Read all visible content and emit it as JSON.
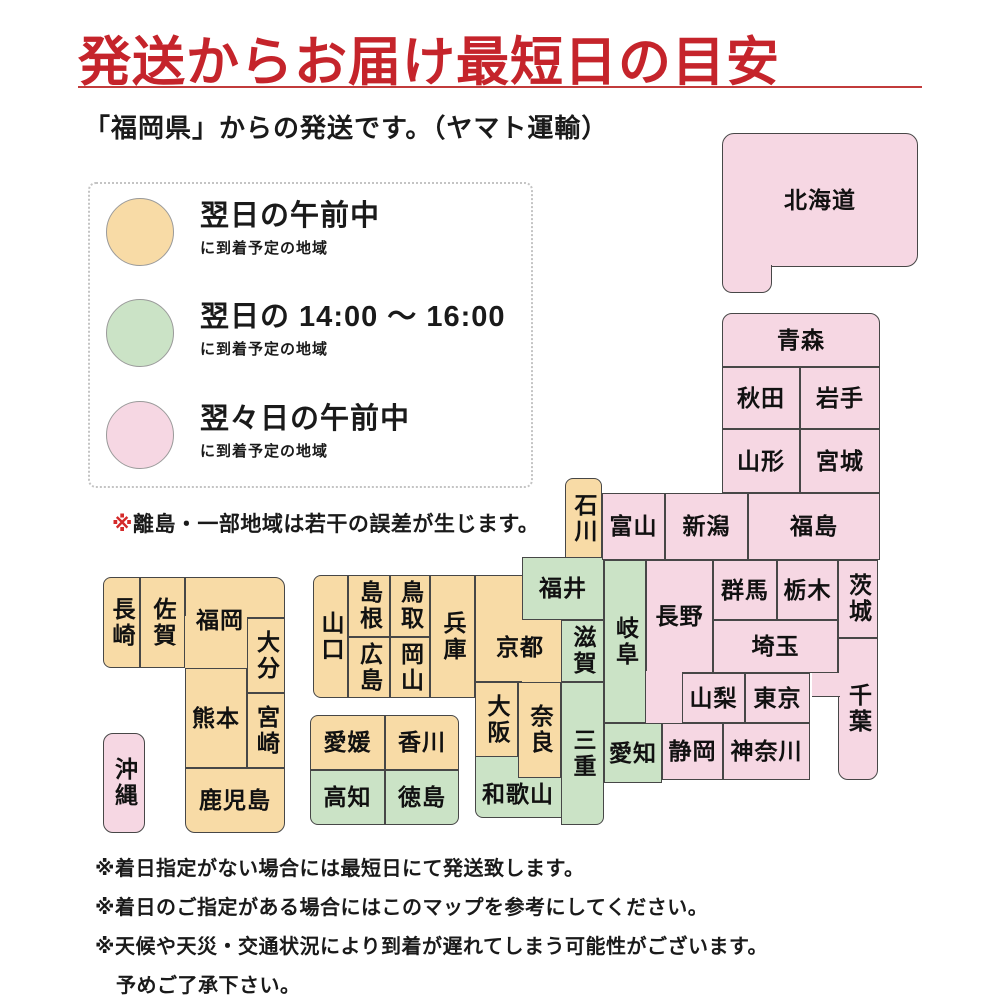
{
  "theme": {
    "title_red": "#c5242b",
    "rule_red": "#c23b3b",
    "note_red": "#d42a2a",
    "map_border": "#474747"
  },
  "header": {
    "title": "発送からお届け最短日の目安",
    "subtitle": "「福岡県」からの発送です。（ヤマト運輸）"
  },
  "legend": {
    "items": [
      {
        "key": "next_am",
        "title": "翌日の午前中",
        "sub": "に到着予定の地域"
      },
      {
        "key": "next_pm",
        "title": "翌日の 14:00 ～ 16:00",
        "sub": "に到着予定の地域"
      },
      {
        "key": "next2_am",
        "title": "翌々日の午前中",
        "sub": "に到着予定の地域"
      }
    ],
    "note_marker": "※",
    "note_text": "離島・一部地域は若干の誤差が生じます。"
  },
  "footnotes": [
    "※着日指定がない場合には最短日にて発送致します。",
    "※着日のご指定がある場合にはこのマップを参考にしてください。",
    "※天候や天災・交通状況により到着が遅れてしまう可能性がございます。",
    "予めご了承下さい。"
  ],
  "map": {
    "colors": {
      "next_am": "#F8DBA6",
      "next_pm": "#CBE3C6",
      "next2_am": "#F6D7E3"
    },
    "legend_meaning": {
      "next_am": "翌日の午前中に到着予定の地域",
      "next_pm": "翌日の14:00～16:00に到着予定の地域",
      "next2_am": "翌々日の午前中に到着予定の地域"
    },
    "prefectures": [
      {
        "id": "nagasaki",
        "label": "長崎",
        "color": "next_am",
        "vertical": true,
        "shapes": [
          {
            "x": 103,
            "y": 577,
            "w": 37,
            "h": 91,
            "r": "8 0 0 8"
          }
        ]
      },
      {
        "id": "saga",
        "label": "佐賀",
        "color": "next_am",
        "vertical": true,
        "shapes": [
          {
            "x": 140,
            "y": 577,
            "w": 45,
            "h": 91
          }
        ]
      },
      {
        "id": "fukuoka",
        "label": "福岡",
        "color": "next_am",
        "vertical": false,
        "shapes": [
          {
            "x": 185,
            "y": 577,
            "w": 100,
            "h": 41,
            "r": "0 10 0 0"
          },
          {
            "x": 185,
            "y": 616,
            "w": 62,
            "h": 52,
            "b": ""
          }
        ],
        "label_box": {
          "x": 185,
          "y": 590,
          "w": 70,
          "h": 60
        }
      },
      {
        "id": "oita",
        "label": "大分",
        "color": "next_am",
        "vertical": true,
        "shapes": [
          {
            "x": 247,
            "y": 618,
            "w": 38,
            "h": 75
          }
        ]
      },
      {
        "id": "kumamoto",
        "label": "熊本",
        "color": "next_am",
        "vertical": false,
        "shapes": [
          {
            "x": 185,
            "y": 668,
            "w": 62,
            "h": 100
          }
        ]
      },
      {
        "id": "miyazaki",
        "label": "宮崎",
        "color": "next_am",
        "vertical": true,
        "shapes": [
          {
            "x": 247,
            "y": 693,
            "w": 38,
            "h": 75
          }
        ]
      },
      {
        "id": "kagoshima",
        "label": "鹿児島",
        "color": "next_am",
        "vertical": false,
        "shapes": [
          {
            "x": 185,
            "y": 768,
            "w": 100,
            "h": 65,
            "r": "0 0 10 10"
          }
        ]
      },
      {
        "id": "yamaguchi",
        "label": "山口",
        "color": "next_am",
        "vertical": true,
        "shapes": [
          {
            "x": 313,
            "y": 575,
            "w": 35,
            "h": 123,
            "r": "8 0 0 8"
          }
        ]
      },
      {
        "id": "shimane",
        "label": "島根",
        "color": "next_am",
        "vertical": true,
        "shapes": [
          {
            "x": 348,
            "y": 575,
            "w": 42,
            "h": 62
          }
        ]
      },
      {
        "id": "tottori",
        "label": "鳥取",
        "color": "next_am",
        "vertical": true,
        "shapes": [
          {
            "x": 390,
            "y": 575,
            "w": 40,
            "h": 62
          }
        ]
      },
      {
        "id": "hiroshima",
        "label": "広島",
        "color": "next_am",
        "vertical": true,
        "shapes": [
          {
            "x": 348,
            "y": 637,
            "w": 42,
            "h": 61
          }
        ]
      },
      {
        "id": "okayama",
        "label": "岡山",
        "color": "next_am",
        "vertical": true,
        "shapes": [
          {
            "x": 390,
            "y": 637,
            "w": 40,
            "h": 61
          }
        ]
      },
      {
        "id": "hyogo",
        "label": "兵庫",
        "color": "next_am",
        "vertical": true,
        "shapes": [
          {
            "x": 430,
            "y": 575,
            "w": 45,
            "h": 123
          }
        ]
      },
      {
        "id": "kyoto",
        "label": "京都",
        "color": "next_am",
        "vertical": false,
        "shapes": [
          {
            "x": 475,
            "y": 575,
            "w": 47,
            "h": 107,
            "b": "ltb"
          },
          {
            "x": 522,
            "y": 620,
            "w": 39,
            "h": 62,
            "b": ""
          }
        ],
        "label_box": {
          "x": 480,
          "y": 625,
          "w": 80,
          "h": 45
        }
      },
      {
        "id": "osaka",
        "label": "大阪",
        "color": "next_am",
        "vertical": true,
        "shapes": [
          {
            "x": 475,
            "y": 682,
            "w": 43,
            "h": 75
          }
        ]
      },
      {
        "id": "nara",
        "label": "奈良",
        "color": "next_am",
        "vertical": true,
        "shapes": [
          {
            "x": 518,
            "y": 682,
            "w": 43,
            "h": 96
          }
        ]
      },
      {
        "id": "ehime",
        "label": "愛媛",
        "color": "next_am",
        "vertical": false,
        "shapes": [
          {
            "x": 310,
            "y": 715,
            "w": 75,
            "h": 55,
            "r": "8 0 0 0"
          }
        ]
      },
      {
        "id": "kagawa",
        "label": "香川",
        "color": "next_am",
        "vertical": false,
        "shapes": [
          {
            "x": 385,
            "y": 715,
            "w": 74,
            "h": 55,
            "r": "0 8 0 0"
          }
        ]
      },
      {
        "id": "ishikawa",
        "label": "石川",
        "color": "next_am",
        "vertical": true,
        "shapes": [
          {
            "x": 565,
            "y": 478,
            "w": 37,
            "h": 82,
            "r": "8 8 0 0"
          }
        ]
      },
      {
        "id": "kochi",
        "label": "高知",
        "color": "next_pm",
        "vertical": false,
        "shapes": [
          {
            "x": 310,
            "y": 770,
            "w": 75,
            "h": 55,
            "r": "0 0 0 8"
          }
        ]
      },
      {
        "id": "tokushima",
        "label": "徳島",
        "color": "next_pm",
        "vertical": false,
        "shapes": [
          {
            "x": 385,
            "y": 770,
            "w": 74,
            "h": 55,
            "r": "0 0 8 0"
          }
        ]
      },
      {
        "id": "wakayama",
        "label": "和歌山",
        "color": "next_pm",
        "vertical": false,
        "shapes": [
          {
            "x": 475,
            "y": 757,
            "w": 43,
            "h": 61,
            "b": "lb",
            "r": "0 0 0 8"
          },
          {
            "x": 518,
            "y": 778,
            "w": 43,
            "h": 40,
            "b": "b"
          }
        ],
        "label_box": {
          "x": 475,
          "y": 770,
          "w": 86,
          "h": 48
        }
      },
      {
        "id": "mie",
        "label": "三重",
        "color": "next_pm",
        "vertical": true,
        "shapes": [
          {
            "x": 561,
            "y": 682,
            "w": 43,
            "h": 143,
            "r": "0 0 8 0"
          }
        ]
      },
      {
        "id": "shiga",
        "label": "滋賀",
        "color": "next_pm",
        "vertical": true,
        "shapes": [
          {
            "x": 561,
            "y": 620,
            "w": 43,
            "h": 62
          }
        ]
      },
      {
        "id": "fukui",
        "label": "福井",
        "color": "next_pm",
        "vertical": false,
        "shapes": [
          {
            "x": 522,
            "y": 557,
            "w": 82,
            "h": 63
          }
        ]
      },
      {
        "id": "gifu",
        "label": "岐阜",
        "color": "next_pm",
        "vertical": true,
        "shapes": [
          {
            "x": 604,
            "y": 560,
            "w": 42,
            "h": 163
          }
        ]
      },
      {
        "id": "aichi",
        "label": "愛知",
        "color": "next_pm",
        "vertical": false,
        "shapes": [
          {
            "x": 604,
            "y": 723,
            "w": 58,
            "h": 60
          }
        ]
      },
      {
        "id": "okinawa",
        "label": "沖縄",
        "color": "next2_am",
        "vertical": true,
        "shapes": [
          {
            "x": 103,
            "y": 733,
            "w": 42,
            "h": 100,
            "r": "10 10 10 10"
          }
        ]
      },
      {
        "id": "toyama",
        "label": "富山",
        "color": "next2_am",
        "vertical": false,
        "shapes": [
          {
            "x": 602,
            "y": 493,
            "w": 63,
            "h": 67
          }
        ]
      },
      {
        "id": "niigata",
        "label": "新潟",
        "color": "next2_am",
        "vertical": false,
        "shapes": [
          {
            "x": 665,
            "y": 493,
            "w": 83,
            "h": 67
          }
        ]
      },
      {
        "id": "nagano",
        "label": "長野",
        "color": "next2_am",
        "vertical": false,
        "shapes": [
          {
            "x": 646,
            "y": 560,
            "w": 67,
            "h": 113
          },
          {
            "x": 646,
            "y": 671,
            "w": 36,
            "h": 52,
            "b": ""
          }
        ],
        "label_box": {
          "x": 646,
          "y": 560,
          "w": 67,
          "h": 113
        }
      },
      {
        "id": "yamanashi",
        "label": "山梨",
        "color": "next2_am",
        "vertical": false,
        "shapes": [
          {
            "x": 682,
            "y": 673,
            "w": 63,
            "h": 50
          }
        ]
      },
      {
        "id": "tokyo",
        "label": "東京",
        "color": "next2_am",
        "vertical": false,
        "shapes": [
          {
            "x": 745,
            "y": 673,
            "w": 65,
            "h": 50
          }
        ]
      },
      {
        "id": "saitama",
        "label": "埼玉",
        "color": "next2_am",
        "vertical": false,
        "shapes": [
          {
            "x": 713,
            "y": 620,
            "w": 125,
            "h": 53
          }
        ]
      },
      {
        "id": "gunma",
        "label": "群馬",
        "color": "next2_am",
        "vertical": false,
        "shapes": [
          {
            "x": 713,
            "y": 560,
            "w": 64,
            "h": 60
          }
        ]
      },
      {
        "id": "tochigi",
        "label": "栃木",
        "color": "next2_am",
        "vertical": false,
        "shapes": [
          {
            "x": 777,
            "y": 560,
            "w": 61,
            "h": 60
          }
        ]
      },
      {
        "id": "ibaraki",
        "label": "茨城",
        "color": "next2_am",
        "vertical": true,
        "shapes": [
          {
            "x": 838,
            "y": 560,
            "w": 40,
            "h": 78
          }
        ]
      },
      {
        "id": "chiba",
        "label": "千葉",
        "color": "next2_am",
        "vertical": true,
        "shapes": [
          {
            "x": 838,
            "y": 638,
            "w": 40,
            "h": 142,
            "r": "0 0 10 10"
          },
          {
            "x": 812,
            "y": 673,
            "w": 28,
            "h": 24,
            "b": "b"
          }
        ],
        "label_box": {
          "x": 838,
          "y": 638,
          "w": 40,
          "h": 142
        }
      },
      {
        "id": "shizuoka",
        "label": "静岡",
        "color": "next2_am",
        "vertical": false,
        "shapes": [
          {
            "x": 662,
            "y": 723,
            "w": 61,
            "h": 57
          }
        ]
      },
      {
        "id": "kanagawa",
        "label": "神奈川",
        "color": "next2_am",
        "vertical": false,
        "shapes": [
          {
            "x": 723,
            "y": 723,
            "w": 87,
            "h": 57
          }
        ]
      },
      {
        "id": "fukushima",
        "label": "福島",
        "color": "next2_am",
        "vertical": false,
        "shapes": [
          {
            "x": 748,
            "y": 493,
            "w": 132,
            "h": 67
          }
        ]
      },
      {
        "id": "yamagata",
        "label": "山形",
        "color": "next2_am",
        "vertical": false,
        "shapes": [
          {
            "x": 722,
            "y": 429,
            "w": 78,
            "h": 64
          }
        ]
      },
      {
        "id": "miyagi",
        "label": "宮城",
        "color": "next2_am",
        "vertical": false,
        "shapes": [
          {
            "x": 800,
            "y": 429,
            "w": 80,
            "h": 64
          }
        ]
      },
      {
        "id": "akita",
        "label": "秋田",
        "color": "next2_am",
        "vertical": false,
        "shapes": [
          {
            "x": 722,
            "y": 367,
            "w": 78,
            "h": 62
          }
        ]
      },
      {
        "id": "iwate",
        "label": "岩手",
        "color": "next2_am",
        "vertical": false,
        "shapes": [
          {
            "x": 800,
            "y": 367,
            "w": 80,
            "h": 62
          }
        ]
      },
      {
        "id": "aomori",
        "label": "青森",
        "color": "next2_am",
        "vertical": false,
        "shapes": [
          {
            "x": 722,
            "y": 313,
            "w": 158,
            "h": 54,
            "r": "10 10 0 0"
          }
        ]
      },
      {
        "id": "hokkaido",
        "label": "北海道",
        "color": "next2_am",
        "vertical": false,
        "shapes": [
          {
            "x": 722,
            "y": 133,
            "w": 196,
            "h": 134,
            "r": "12 12 12 0"
          },
          {
            "x": 722,
            "y": 265,
            "w": 50,
            "h": 28,
            "b": "lrb",
            "r": "0 0 10 10"
          }
        ],
        "label_box": {
          "x": 722,
          "y": 133,
          "w": 196,
          "h": 134
        }
      }
    ]
  }
}
